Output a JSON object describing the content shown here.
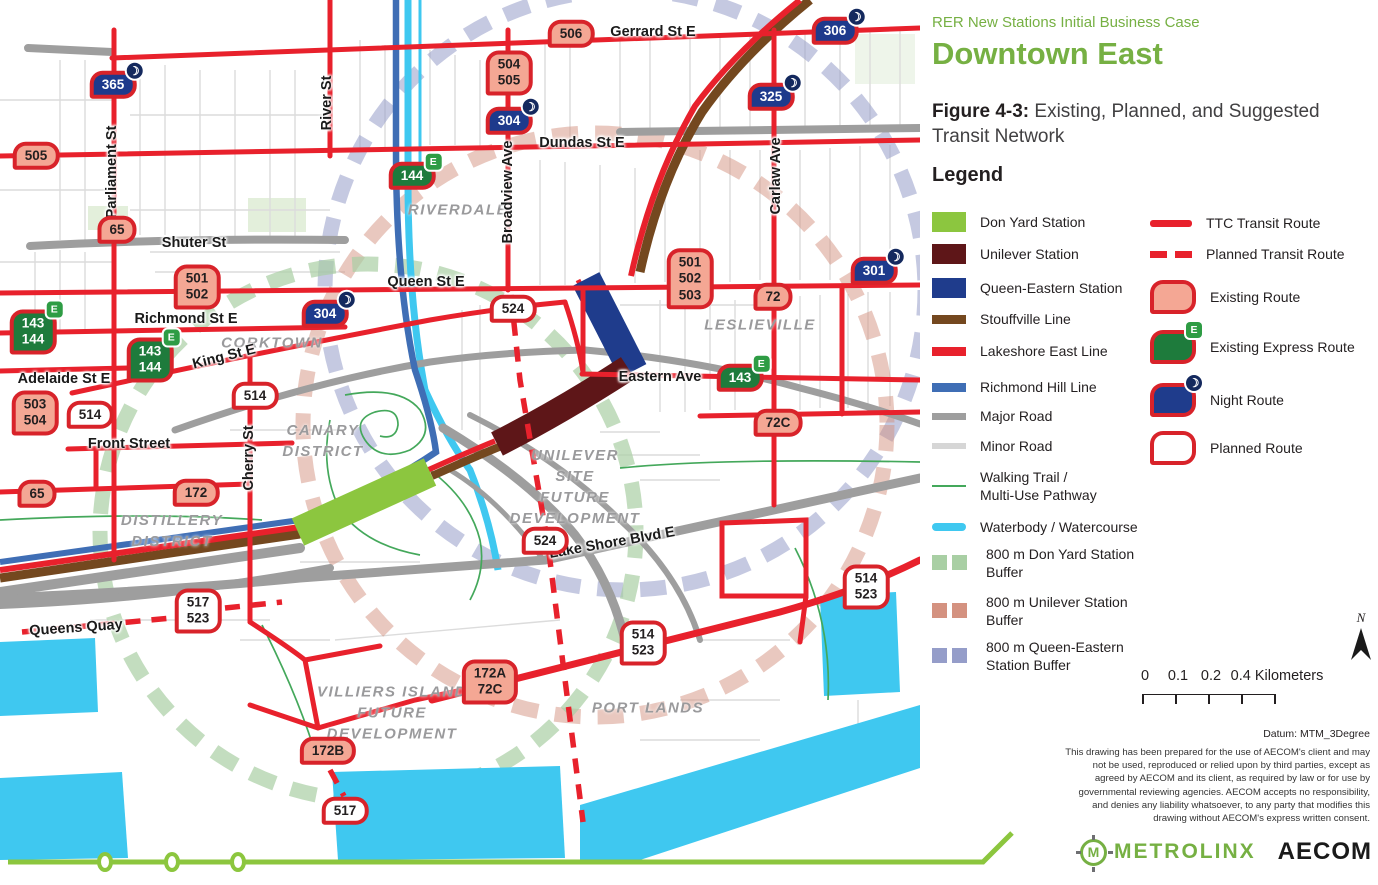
{
  "panel": {
    "kicker": "RER New Stations Initial Business Case",
    "title": "Downtown East",
    "figure_label": "Figure 4-3:",
    "figure_caption": " Existing, Planned, and Suggested Transit Network",
    "legend_title": "Legend",
    "legend_left": [
      {
        "swatch": "don-yard",
        "label": "Don Yard Station"
      },
      {
        "swatch": "unilever",
        "label": "Unilever Station"
      },
      {
        "swatch": "queen-eastern",
        "label": "Queen-Eastern Station"
      },
      {
        "swatch": "stouffville",
        "label": "Stouffville Line"
      },
      {
        "swatch": "lakeshore",
        "label": "Lakeshore East Line"
      },
      {
        "swatch": "richmond-hill",
        "label": "Richmond Hill Line"
      },
      {
        "swatch": "major-road",
        "label": "Major Road"
      },
      {
        "swatch": "minor-road",
        "label": "Minor Road"
      },
      {
        "swatch": "trail",
        "label": "Walking Trail /\nMulti-Use Pathway"
      },
      {
        "swatch": "water",
        "label": "Waterbody / Watercourse"
      },
      {
        "swatch": "buffer-green",
        "label": "800 m  Don Yard Station\nBuffer"
      },
      {
        "swatch": "buffer-salmon",
        "label": "800 m  Unilever Station\nBuffer"
      },
      {
        "swatch": "buffer-blue",
        "label": "800 m Queen-Eastern\nStation Buffer"
      }
    ],
    "legend_right": [
      {
        "swatch": "ttc-route",
        "label": "TTC Transit Route"
      },
      {
        "swatch": "planned-transit",
        "label": "Planned Transit Route"
      },
      {
        "swatch": "badge-existing",
        "label": "Existing Route"
      },
      {
        "swatch": "badge-express",
        "label": "Existing Express Route",
        "icon": "E"
      },
      {
        "swatch": "badge-night",
        "label": "Night Route",
        "icon": "moon"
      },
      {
        "swatch": "badge-planned",
        "label": "Planned Route"
      }
    ],
    "scalebar": {
      "labels": [
        "0",
        "0.1",
        "0.2",
        "0.4 Kilometers"
      ],
      "label_x": [
        3,
        36,
        69,
        135
      ]
    },
    "north_label": "N",
    "datum": "Datum: MTM_3Degree",
    "disclaimer": "This drawing has been prepared for the use of AECOM's client and may not be used, reproduced or relied upon by third parties, except as agreed by AECOM and its client, as required by law or for use by governmental reviewing agencies. AECOM accepts no responsibility, and denies any liability whatsoever, to any party that modifies this drawing without AECOM's express written consent.",
    "logos": {
      "metrolinx": "METROLINX",
      "metrolinx_initial": "M",
      "aecom": "AECOM"
    }
  },
  "map": {
    "badges": [
      {
        "lines": [
          "365"
        ],
        "type": "night",
        "x": 113,
        "y": 85
      },
      {
        "lines": [
          "505"
        ],
        "type": "existing",
        "x": 36,
        "y": 156
      },
      {
        "lines": [
          "506"
        ],
        "type": "existing",
        "x": 571,
        "y": 34
      },
      {
        "lines": [
          "504",
          "505"
        ],
        "type": "existing",
        "x": 509,
        "y": 73
      },
      {
        "lines": [
          "306"
        ],
        "type": "night",
        "x": 835,
        "y": 31
      },
      {
        "lines": [
          "304"
        ],
        "type": "night",
        "x": 509,
        "y": 121
      },
      {
        "lines": [
          "325"
        ],
        "type": "night",
        "x": 771,
        "y": 97
      },
      {
        "lines": [
          "144"
        ],
        "type": "express",
        "x": 412,
        "y": 176
      },
      {
        "lines": [
          "65"
        ],
        "type": "existing",
        "x": 117,
        "y": 230
      },
      {
        "lines": [
          "501",
          "502"
        ],
        "type": "existing",
        "x": 197,
        "y": 287
      },
      {
        "lines": [
          "301"
        ],
        "type": "night",
        "x": 874,
        "y": 271
      },
      {
        "lines": [
          "304"
        ],
        "type": "night",
        "x": 325,
        "y": 314
      },
      {
        "lines": [
          "524"
        ],
        "type": "planned",
        "x": 513,
        "y": 309
      },
      {
        "lines": [
          "501",
          "502",
          "503"
        ],
        "type": "existing",
        "x": 690,
        "y": 279
      },
      {
        "lines": [
          "72"
        ],
        "type": "existing",
        "x": 773,
        "y": 297
      },
      {
        "lines": [
          "143",
          "144"
        ],
        "type": "express",
        "x": 33,
        "y": 332
      },
      {
        "lines": [
          "143",
          "144"
        ],
        "type": "express",
        "x": 150,
        "y": 360
      },
      {
        "lines": [
          "503",
          "504"
        ],
        "type": "existing",
        "x": 35,
        "y": 413
      },
      {
        "lines": [
          "514"
        ],
        "type": "planned",
        "x": 90,
        "y": 415
      },
      {
        "lines": [
          "514"
        ],
        "type": "planned",
        "x": 255,
        "y": 396
      },
      {
        "lines": [
          "143"
        ],
        "type": "express",
        "x": 740,
        "y": 378
      },
      {
        "lines": [
          "72C"
        ],
        "type": "existing",
        "x": 778,
        "y": 423
      },
      {
        "lines": [
          "65"
        ],
        "type": "existing",
        "x": 37,
        "y": 494
      },
      {
        "lines": [
          "172"
        ],
        "type": "existing",
        "x": 196,
        "y": 493
      },
      {
        "lines": [
          "524"
        ],
        "type": "planned",
        "x": 545,
        "y": 541
      },
      {
        "lines": [
          "514",
          "523"
        ],
        "type": "planned",
        "x": 866,
        "y": 587
      },
      {
        "lines": [
          "517",
          "523"
        ],
        "type": "planned",
        "x": 198,
        "y": 611
      },
      {
        "lines": [
          "514",
          "523"
        ],
        "type": "planned",
        "x": 643,
        "y": 643
      },
      {
        "lines": [
          "172A",
          "72C"
        ],
        "type": "existing",
        "x": 490,
        "y": 682
      },
      {
        "lines": [
          "172B"
        ],
        "type": "existing",
        "x": 328,
        "y": 751
      },
      {
        "lines": [
          "517"
        ],
        "type": "planned",
        "x": 345,
        "y": 811
      }
    ],
    "street_labels": [
      {
        "text": "Gerrard St E",
        "x": 653,
        "y": 32,
        "rot": 0
      },
      {
        "text": "Dundas St E",
        "x": 582,
        "y": 143,
        "rot": 0
      },
      {
        "text": "Shuter St",
        "x": 194,
        "y": 243,
        "rot": 0
      },
      {
        "text": "Queen St E",
        "x": 426,
        "y": 282,
        "rot": 0
      },
      {
        "text": "Richmond St E",
        "x": 186,
        "y": 319,
        "rot": 0
      },
      {
        "text": "King St E",
        "x": 224,
        "y": 357,
        "rot": -14
      },
      {
        "text": "Adelaide St E",
        "x": 64,
        "y": 379,
        "rot": 0
      },
      {
        "text": "Front Street",
        "x": 129,
        "y": 444,
        "rot": 0
      },
      {
        "text": "Eastern Ave",
        "x": 660,
        "y": 377,
        "rot": 0
      },
      {
        "text": "Lake Shore Blvd E",
        "x": 612,
        "y": 543,
        "rot": -10
      },
      {
        "text": "Queens Quay",
        "x": 76,
        "y": 628,
        "rot": -4
      },
      {
        "text": "Parliament St",
        "x": 112,
        "y": 172,
        "rot": -90
      },
      {
        "text": "River St",
        "x": 327,
        "y": 103,
        "rot": -90
      },
      {
        "text": "Broadview Ave",
        "x": 508,
        "y": 192,
        "rot": -90
      },
      {
        "text": "Carlaw Ave",
        "x": 776,
        "y": 176,
        "rot": -90
      },
      {
        "text": "Cherry St",
        "x": 249,
        "y": 458,
        "rot": -90
      }
    ],
    "district_labels": [
      {
        "text": "RIVERDALE",
        "x": 458,
        "y": 210
      },
      {
        "text": "CORKTOWN",
        "x": 272,
        "y": 343
      },
      {
        "text": "LESLIEVILLE",
        "x": 760,
        "y": 325
      },
      {
        "text": "CANARY\nDISTRICT",
        "x": 323,
        "y": 441
      },
      {
        "text": "DISTILLERY\nDISTRICT",
        "x": 172,
        "y": 531
      },
      {
        "text": "UNILEVER\nSITE\nFUTURE\nDEVELOPMENT",
        "x": 575,
        "y": 487
      },
      {
        "text": "VILLIERS ISLAND\nFUTURE\nDEVELOPMENT",
        "x": 392,
        "y": 713
      },
      {
        "text": "PORT LANDS",
        "x": 648,
        "y": 708
      }
    ],
    "colors": {
      "ttc_red": "#E8212C",
      "badge_border": "#D8232A",
      "existing_fill": "#F4A794",
      "express_green": "#1E7B3C",
      "night_navy": "#1E3A8C",
      "stouffville_brown": "#74481F",
      "lakeshore_red": "#E8212C",
      "richmond_hill_blue": "#3F6EB5",
      "don_yard_green": "#8CC63F",
      "unilever_maroon": "#5E1618",
      "queen_eastern_navy": "#1F3C8C",
      "water_cyan": "#3FC8F0",
      "major_road": "#9E9E9E",
      "minor_road": "#D6D6D6",
      "trail_green": "#44A85B",
      "buffer_green": "#A9CFA4",
      "buffer_salmon": "#D49280",
      "buffer_blue": "#959DC9",
      "accent_green": "#76B043"
    }
  }
}
